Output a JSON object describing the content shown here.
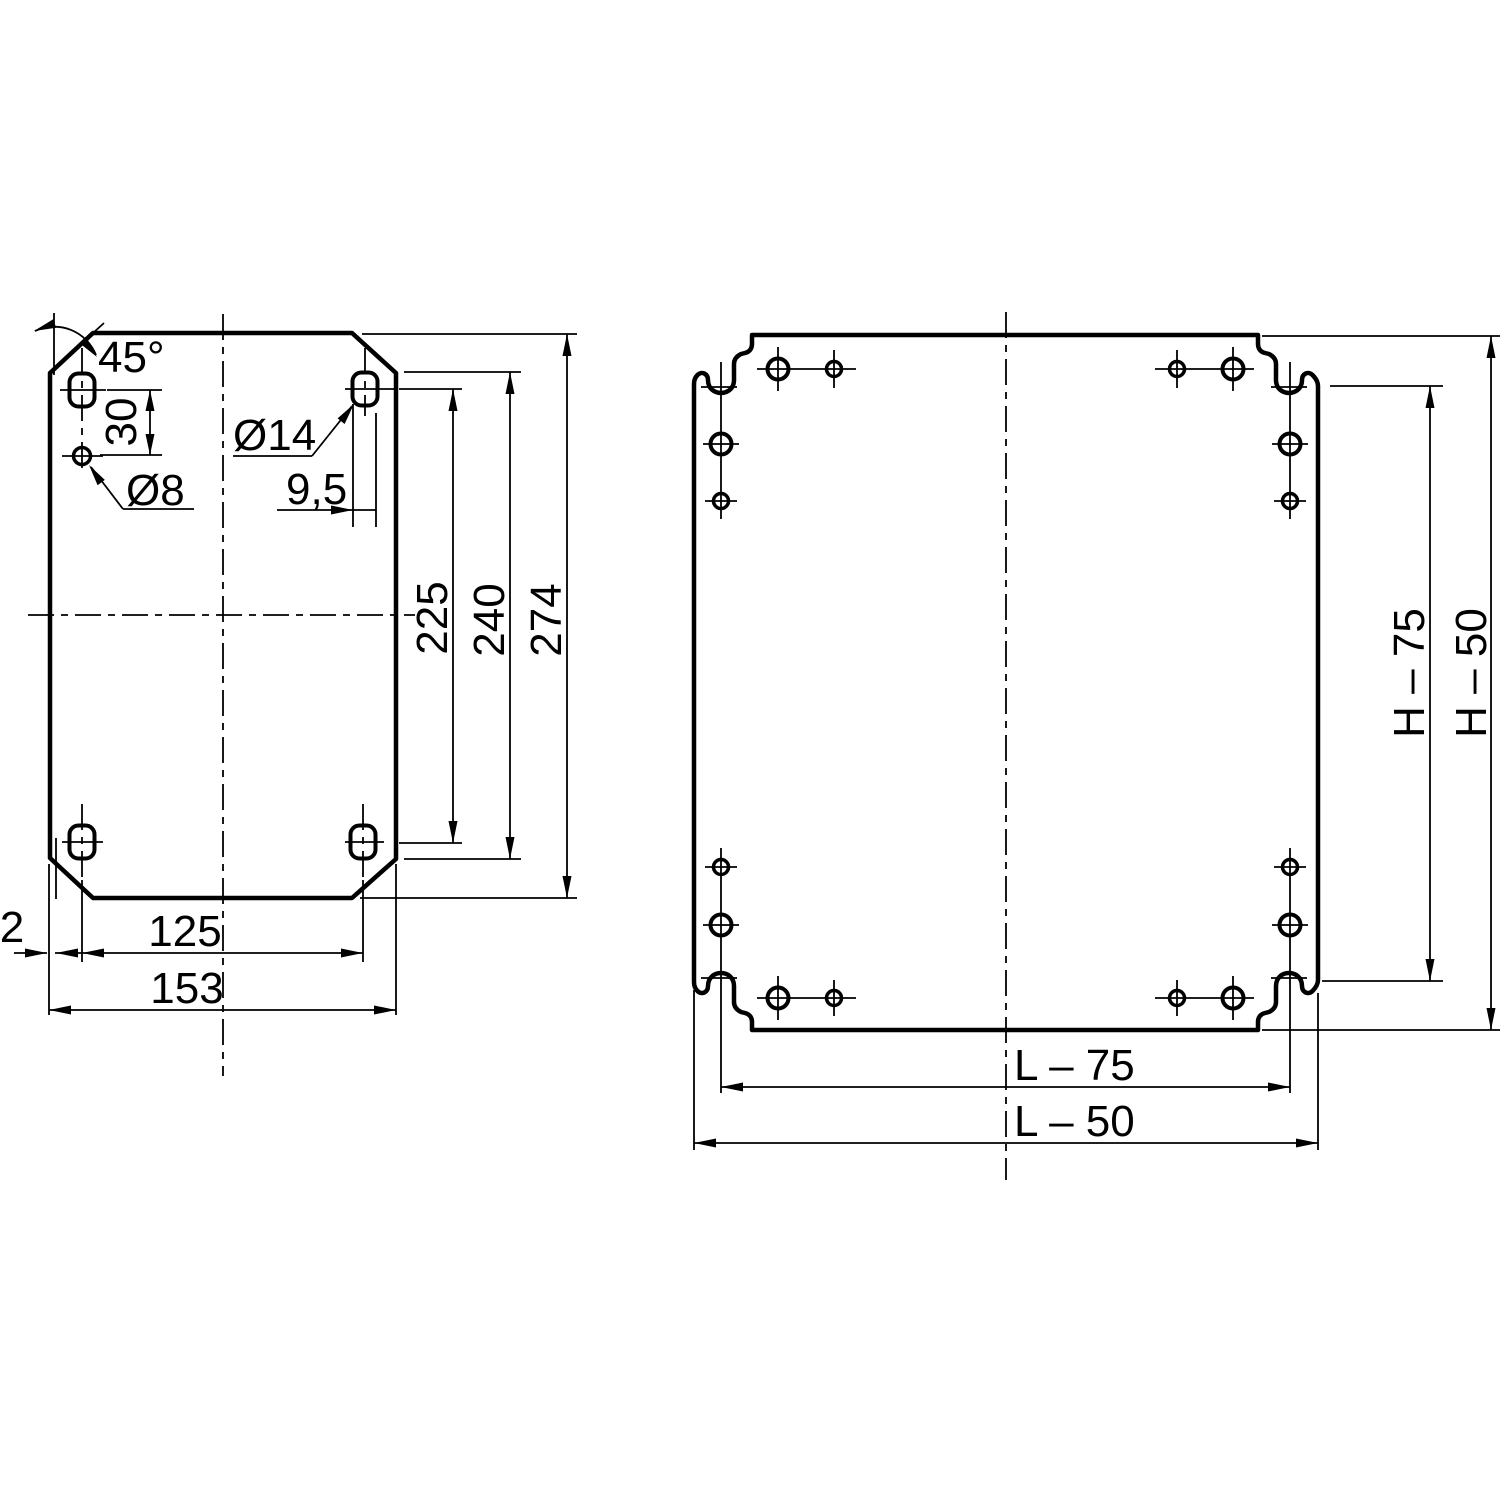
{
  "colors": {
    "background": "#ffffff",
    "line": "#000000"
  },
  "left_view": {
    "labels": {
      "chamfer_angle": "45°",
      "hole_spacing": "30",
      "slot_diameter": "Ø14",
      "hole_diameter": "Ø8",
      "slot_width": "9,5",
      "height_to_holes": "225",
      "height_to_edge": "240",
      "height_total": "274",
      "width_between_holes": "125",
      "width_total": "153",
      "edge_offset": "2"
    }
  },
  "right_view": {
    "labels": {
      "height_between_slots": "H – 75",
      "height_total": "H – 50",
      "width_between_slots": "L – 75",
      "width_total": "L – 50"
    }
  }
}
